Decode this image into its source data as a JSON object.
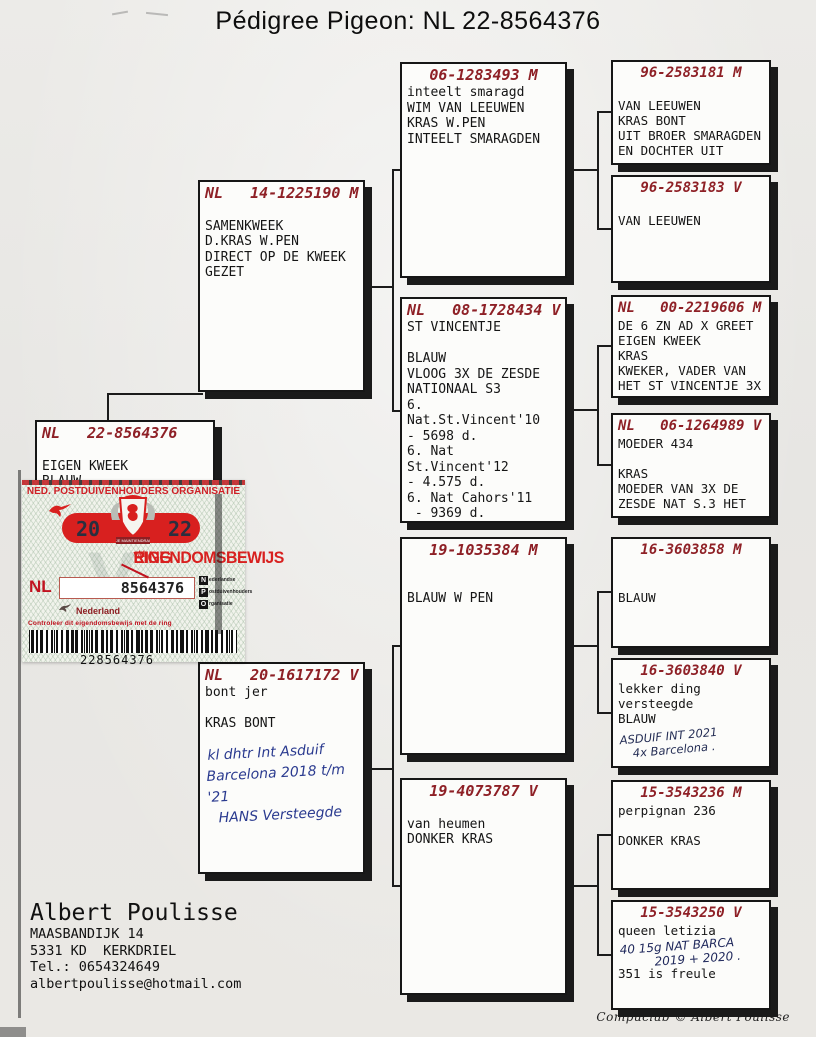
{
  "title": "Pédigree Pigeon: NL  22-8564376",
  "colors": {
    "header_red": "#8e2026",
    "stamp_red": "#d8201f",
    "ink_blue": "#2a3a8f"
  },
  "boxes": {
    "subject": {
      "ring": "NL   22-8564376",
      "lines": [
        "",
        "EIGEN KWEEK",
        "BLAUW"
      ]
    },
    "sire": {
      "ring": "NL   14-1225190 M",
      "lines": [
        "",
        "SAMENKWEEK",
        "D.KRAS W.PEN",
        "DIRECT OP DE KWEEK",
        "GEZET"
      ]
    },
    "dam": {
      "ring": "NL   20-1617172 V",
      "lines": [
        "bont jer",
        "",
        "KRAS BONT"
      ],
      "handwriting": [
        "kl dhtr Int Asduif",
        "Barcelona 2018 t/m '21",
        "HANS Versteegde"
      ]
    },
    "sire_sire": {
      "ring": "06-1283493 M",
      "lines": [
        "inteelt smaragd",
        "WIM VAN LEEUWEN",
        "KRAS W.PEN",
        "INTEELT SMARAGDEN"
      ]
    },
    "sire_dam": {
      "ring": "NL   08-1728434 V",
      "lines": [
        "ST VINCENTJE",
        "",
        "BLAUW",
        "VLOOG 3X DE ZESDE",
        "NATIONAAL S3",
        "6.",
        "Nat.St.Vincent'10",
        "- 5698 d.",
        "6. Nat",
        "St.Vincent'12",
        "- 4.575 d.",
        "6. Nat Cahors'11",
        " - 9369 d."
      ]
    },
    "dam_sire": {
      "ring": "19-1035384 M",
      "lines": [
        "",
        "",
        "BLAUW W PEN"
      ]
    },
    "dam_dam": {
      "ring": "19-4073787 V",
      "lines": [
        "",
        "van heumen",
        "DONKER KRAS"
      ]
    },
    "ss_sire": {
      "ring": "96-2583181 M",
      "lines": [
        "",
        "VAN LEEUWEN",
        "KRAS BONT",
        "UIT BROER SMARAGDEN",
        "EN DOCHTER UIT"
      ]
    },
    "ss_dam": {
      "ring": "96-2583183 V",
      "lines": [
        "",
        "VAN LEEUWEN"
      ]
    },
    "sd_sire": {
      "ring": "NL   00-2219606 M",
      "lines": [
        "DE 6 ZN AD X GREET",
        "EIGEN KWEEK",
        "KRAS",
        "KWEKER, VADER VAN",
        "HET ST VINCENTJE 3X"
      ]
    },
    "sd_dam": {
      "ring": "NL   06-1264989 V",
      "lines": [
        "MOEDER 434",
        "",
        "KRAS",
        "MOEDER VAN 3X DE",
        "ZESDE NAT S.3 HET"
      ]
    },
    "ds_sire": {
      "ring": "16-3603858 M",
      "lines": [
        "",
        "",
        "BLAUW"
      ]
    },
    "ds_dam": {
      "ring": "16-3603840 V",
      "lines": [
        "lekker ding",
        "versteegde",
        "BLAUW"
      ],
      "handwriting": [
        "ASDUIF INT 2021",
        "4x Barcelona ."
      ]
    },
    "dd_sire": {
      "ring": "15-3543236 M",
      "lines": [
        "perpignan 236",
        "",
        "DONKER KRAS"
      ]
    },
    "dd_dam": {
      "ring": "15-3543250 V",
      "lines": [
        "queen letizia"
      ],
      "handwriting": [
        "40 15g NAT BARCA",
        "2019 + 2020 ."
      ],
      "lines_after": [
        "351 is freule"
      ]
    }
  },
  "stamp": {
    "org": "NED. POSTDUIVENHOUDERS ORGANISATIE",
    "year_left": "20",
    "year_right": "22",
    "motto": "JE MAINTIENDRAI",
    "title_main": "EIGENDOMSBEWIJS",
    "title_mid": "v/d",
    "title_end": "RING",
    "watermark_letter": "V",
    "country_code": "NL",
    "ring_number": "8564376",
    "country": "Nederland",
    "npo": [
      {
        "letter": "N",
        "word": "ederlandse"
      },
      {
        "letter": "P",
        "word": "ostduivenhouders"
      },
      {
        "letter": "O",
        "word": "rganisatie"
      }
    ],
    "control_text": "Controleer dit eigendomsbewijs met de ring",
    "barcode_number": "228564376"
  },
  "owner": {
    "name": "Albert Poulisse",
    "lines": [
      "MAASBANDIJK 14",
      "5331 KD  KERKDRIEL",
      "Tel.: 0654324649",
      "albertpoulisse@hotmail.com"
    ]
  },
  "credit": "Compuclub © Albert Poulisse"
}
